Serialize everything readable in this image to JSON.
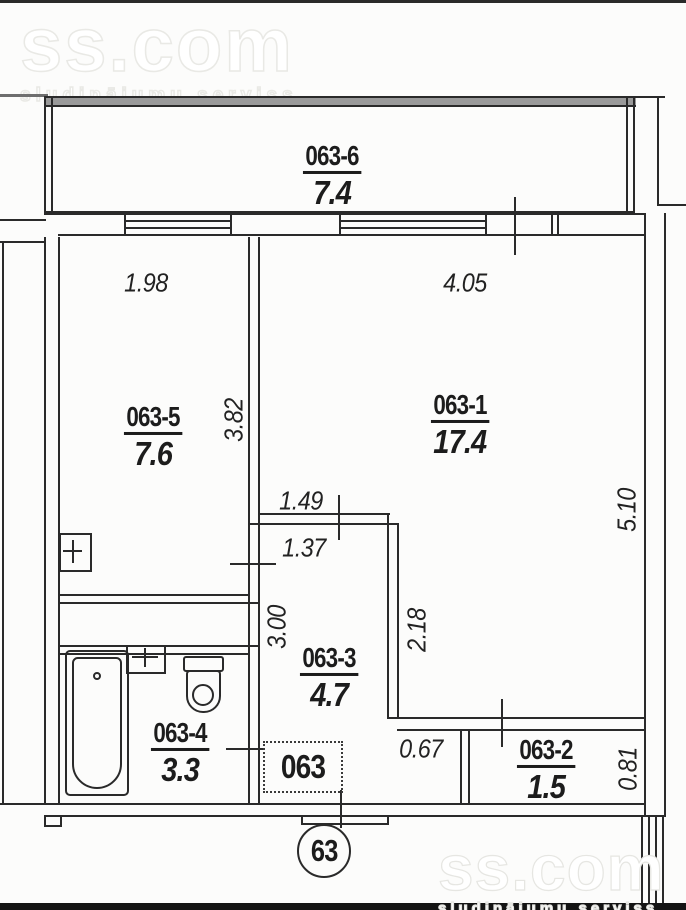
{
  "brand": {
    "logo": "ss.com",
    "tagline": "sludinājumu serviss"
  },
  "plan": {
    "apartment_label": "063",
    "unit_circle_label": "63",
    "rooms": [
      {
        "id": "063-1",
        "area": "17.4"
      },
      {
        "id": "063-2",
        "area": "1.5"
      },
      {
        "id": "063-3",
        "area": "4.7"
      },
      {
        "id": "063-4",
        "area": "3.3"
      },
      {
        "id": "063-5",
        "area": "7.6"
      },
      {
        "id": "063-6",
        "area": "7.4"
      }
    ],
    "dimensions": [
      {
        "value": "1.98",
        "orientation": "horizontal"
      },
      {
        "value": "4.05",
        "orientation": "horizontal"
      },
      {
        "value": "3.82",
        "orientation": "vertical"
      },
      {
        "value": "5.10",
        "orientation": "vertical"
      },
      {
        "value": "1.49",
        "orientation": "horizontal"
      },
      {
        "value": "1.37",
        "orientation": "horizontal"
      },
      {
        "value": "3.00",
        "orientation": "vertical"
      },
      {
        "value": "2.18",
        "orientation": "vertical"
      },
      {
        "value": "0.67",
        "orientation": "horizontal"
      },
      {
        "value": "0.81",
        "orientation": "vertical"
      }
    ],
    "fixtures": [
      "bathtub",
      "toilet",
      "vent-shaft",
      "vent-shaft"
    ]
  }
}
